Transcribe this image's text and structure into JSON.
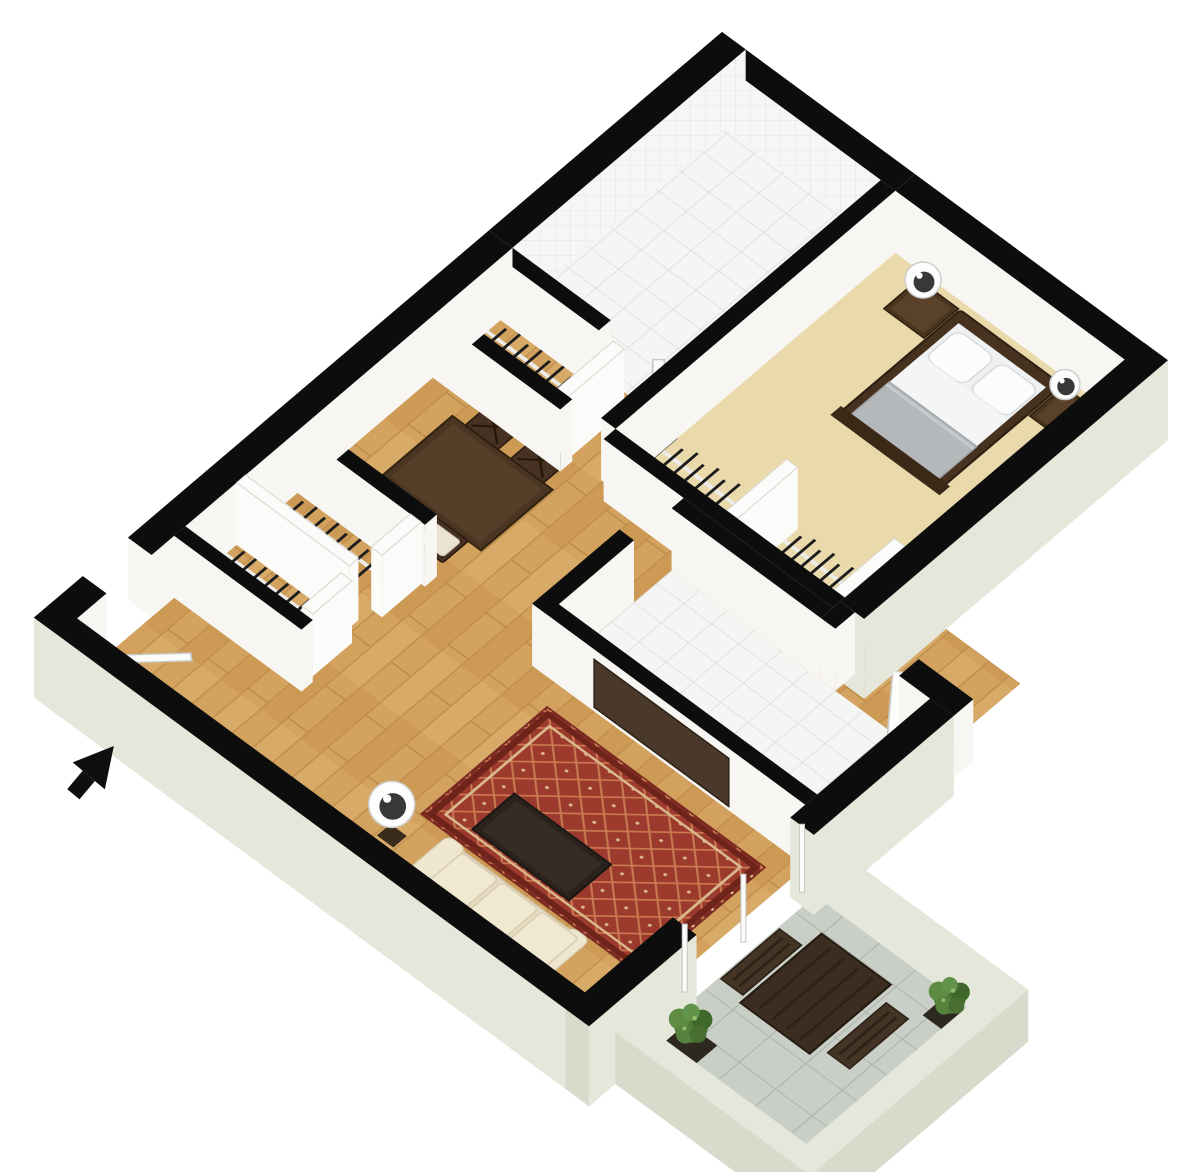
{
  "canvas": {
    "width": 1200,
    "height": 1172
  },
  "floorplan": {
    "view": "3d-isometric-floor-plan",
    "projection": {
      "a": 0.91,
      "b": 0.67,
      "c": -0.752,
      "d": 0.64,
      "e": 722,
      "f": 32
    },
    "wall_height": 62,
    "colors": {
      "wall": "#0d0d0d",
      "interior_face": "#f7f6f3",
      "exterior": "#e5e7db",
      "exterior_shade": "#d8dbcc",
      "panel": "#fbfbf9",
      "carpet": "#eadaab",
      "wood_base": "#d2a25e",
      "tile_white": "#f5f5f3",
      "tile_gray": "#c9cec6",
      "rug_field": "#9d3a2e",
      "rug_accent": "#d9b98c",
      "dark_wood": "#4a3522",
      "espresso": "#2a231d",
      "sofa_cream": "#e6dcc3",
      "bedding_white": "#f2f3f4",
      "blanket_gray": "#b5b8ba",
      "foliage_green": "#4e7a37",
      "arrow_black": "#0f0f0f"
    },
    "floors": [
      {
        "name": "floor-living-dining-wood",
        "rect": [
          26,
          310,
          584,
          889
        ],
        "surface": "wood"
      },
      {
        "name": "floor-bedroom-carpet",
        "rect": [
          212,
          26,
          464,
          398
        ],
        "surface": "carpet"
      },
      {
        "name": "floor-bathroom-tile",
        "rect": [
          26,
          26,
          196,
          310
        ],
        "surface": "tile"
      },
      {
        "name": "floor-kitchen-tile",
        "rect": [
          300,
          430,
          584,
          580
        ],
        "surface": "tile"
      },
      {
        "name": "floor-balcony-tile",
        "rect": [
          610,
          614,
          800,
          856
        ],
        "surface": "tile-gray"
      }
    ],
    "walls": [
      {
        "name": "wall-ne-bathroom",
        "rect": [
          0,
          0,
          212,
          26
        ],
        "face": "tile"
      },
      {
        "name": "wall-ne-bedroom",
        "rect": [
          212,
          0,
          490,
          26
        ],
        "face": "white"
      },
      {
        "name": "wall-nw-bathroom",
        "rect": [
          0,
          0,
          26,
          310
        ],
        "face": "tile"
      },
      {
        "name": "wall-nw-mid",
        "rect": [
          0,
          310,
          26,
          790
        ],
        "face": "white"
      },
      {
        "name": "wall-nw-end",
        "rect": [
          0,
          850,
          26,
          915
        ],
        "face": "white"
      },
      {
        "name": "wall-sw-living",
        "rect": [
          0,
          889,
          610,
          915
        ],
        "face": "pale",
        "cap": "pale-dark",
        "ext": true
      },
      {
        "name": "wall-se-bedroom",
        "rect": [
          464,
          0,
          490,
          404
        ],
        "face": "pale",
        "ext": true
      },
      {
        "name": "wall-step-a",
        "rect": [
          464,
          404,
          480,
          430
        ],
        "face": "white"
      },
      {
        "name": "wall-step-b",
        "rect": [
          550,
          404,
          610,
          430
        ],
        "face": "white"
      },
      {
        "name": "wall-se-wing-a",
        "rect": [
          584,
          430,
          610,
          616
        ],
        "face": "pale",
        "ext": true
      },
      {
        "name": "wall-se-wing-b",
        "rect": [
          584,
          772,
          610,
          915
        ],
        "face": "pale",
        "cap": "pale-dark",
        "ext": true
      },
      {
        "name": "wall-bath-bedroom-divider",
        "rect": [
          196,
          26,
          212,
          398
        ],
        "face": "white"
      },
      {
        "name": "wall-bath-sw",
        "rect": [
          26,
          310,
          134,
          326
        ],
        "face": "white"
      },
      {
        "name": "panel-linen-side",
        "rect": [
          150,
          326,
          162,
          400
        ],
        "face": "panel",
        "top": "panel"
      },
      {
        "name": "wall-linen-sw",
        "rect": [
          26,
          400,
          166,
          416
        ],
        "face": "white"
      },
      {
        "name": "wall-closet-back",
        "rect": [
          212,
          398,
          464,
          414
        ],
        "face": "white"
      },
      {
        "name": "wall-kitchen-ne",
        "rect": [
          300,
          414,
          464,
          430
        ],
        "face": "white"
      },
      {
        "name": "panel-closet-divider-a",
        "rect": [
          334,
          318,
          346,
          398
        ],
        "face": "panel",
        "top": "panel"
      },
      {
        "name": "panel-closet-divider-b",
        "rect": [
          452,
          318,
          464,
          398
        ],
        "face": "panel",
        "top": "panel"
      },
      {
        "name": "wall-kitchen-nw",
        "rect": [
          284,
          480,
          300,
          596
        ],
        "face": "white"
      },
      {
        "name": "wall-kitchen-sw-tv",
        "rect": [
          284,
          580,
          584,
          596
        ],
        "face": "white"
      },
      {
        "name": "wall-hall-closet-n",
        "rect": [
          26,
          580,
          166,
          596
        ],
        "face": "white"
      },
      {
        "name": "panel-hall-closet-divider",
        "rect": [
          26,
          665,
          150,
          677
        ],
        "face": "panel",
        "top": "panel"
      },
      {
        "name": "wall-hall-closet-s",
        "rect": [
          26,
          745,
          166,
          760
        ],
        "face": "white"
      },
      {
        "name": "panel-hall-closet-post-a",
        "rect": [
          150,
          596,
          162,
          648
        ],
        "face": "panel",
        "top": "panel"
      },
      {
        "name": "panel-hall-closet-post-b",
        "rect": [
          150,
          688,
          162,
          740
        ],
        "face": "panel",
        "top": "panel"
      },
      {
        "name": "parapet-balcony-ne",
        "rect": [
          610,
          590,
          824,
          614
        ],
        "face": "pale",
        "top": "pale",
        "h": 34
      },
      {
        "name": "parapet-balcony-se",
        "rect": [
          800,
          590,
          824,
          880
        ],
        "face": "pale-dark",
        "top": "pale",
        "h": 34,
        "ext": true
      },
      {
        "name": "parapet-balcony-sw",
        "rect": [
          610,
          856,
          824,
          880
        ],
        "face": "pale-dark",
        "top": "pale",
        "h": 34,
        "ext": true
      }
    ],
    "furniture": [
      {
        "name": "bed-frame",
        "type": "rect",
        "r": [
          290,
          34,
          402,
          198
        ],
        "fill": "#46321e",
        "stroke": "#2f2013",
        "sw": 2,
        "rx": 3
      },
      {
        "name": "bed-mattress",
        "type": "rect",
        "r": [
          298,
          46,
          394,
          190
        ],
        "fill": "#eef0f1"
      },
      {
        "name": "bed-pillow-left",
        "type": "rect",
        "r": [
          302,
          52,
          344,
          96
        ],
        "fill": "#fbfcfd",
        "stroke": "#d9dbdd",
        "sw": 1.5,
        "rx": 9
      },
      {
        "name": "bed-pillow-right",
        "type": "rect",
        "r": [
          350,
          52,
          392,
          96
        ],
        "fill": "#fbfcfd",
        "stroke": "#d9dbdd",
        "sw": 1.5,
        "rx": 9
      },
      {
        "name": "bed-sheet",
        "type": "rect",
        "r": [
          298,
          96,
          394,
          150
        ],
        "fill": "#f4f5f6"
      },
      {
        "name": "bed-blanket",
        "type": "rect",
        "r": [
          298,
          138,
          394,
          190
        ],
        "fill": "#b5b8ba",
        "stroke": "#a3a6a8",
        "sw": 1.5
      },
      {
        "name": "bed-blanket-fold",
        "type": "line",
        "a": [
          298,
          142
        ],
        "b": [
          394,
          142
        ],
        "stroke": "#c8cbcd",
        "w": 3
      },
      {
        "name": "bed-footboard",
        "type": "rect",
        "r": [
          286,
          188,
          406,
          202
        ],
        "fill": "#3a2916"
      },
      {
        "name": "nightstand-left",
        "type": "rect",
        "r": [
          244,
          34,
          288,
          80
        ],
        "fill": "#4a3420",
        "stroke": "#30210f",
        "sw": 1.5
      },
      {
        "name": "nightstand-left-top",
        "type": "rect",
        "r": [
          248,
          38,
          284,
          76
        ],
        "fill": "#5a4129"
      },
      {
        "name": "nightstand-right",
        "type": "rect",
        "r": [
          404,
          34,
          448,
          80
        ],
        "fill": "#4a3420",
        "stroke": "#30210f",
        "sw": 1.5
      },
      {
        "name": "nightstand-right-top",
        "type": "rect",
        "r": [
          408,
          38,
          444,
          76
        ],
        "fill": "#5a4129"
      },
      {
        "name": "dining-table",
        "type": "rect",
        "r": [
          64,
          436,
          174,
          531
        ],
        "fill": "#4a3522",
        "stroke": "#33240f",
        "sw": 2
      },
      {
        "name": "dining-table-top",
        "type": "rect",
        "r": [
          70,
          442,
          168,
          525
        ],
        "fill": "#563f28"
      },
      {
        "name": "dining-chair-ne-1",
        "type": "chair",
        "r": [
          78,
          402,
          114,
          436
        ],
        "fill": "#463122",
        "cushion": false
      },
      {
        "name": "dining-chair-ne-2",
        "type": "chair",
        "r": [
          128,
          402,
          164,
          436
        ],
        "fill": "#463122",
        "cushion": false
      },
      {
        "name": "dining-chair-sw-1",
        "type": "chair",
        "r": [
          74,
          531,
          110,
          565
        ],
        "fill": "#463122",
        "cushion": true
      },
      {
        "name": "dining-chair-sw-2",
        "type": "chair",
        "r": [
          124,
          531,
          160,
          565
        ],
        "fill": "#463122",
        "cushion": true
      },
      {
        "name": "area-rug-base",
        "type": "rect",
        "r": [
          322,
          622,
          560,
          788
        ],
        "fill": "#9d3a2e",
        "stroke": "#7a2a20",
        "sw": 3
      },
      {
        "name": "area-rug-lattice",
        "type": "rect",
        "r": [
          322,
          622,
          560,
          788
        ],
        "fill": "url(#pRug)"
      },
      {
        "name": "area-rug-border-outer",
        "type": "rect",
        "r": [
          327,
          627,
          555,
          783
        ],
        "fill": "none",
        "stroke": "#6f241b",
        "sw": 6
      },
      {
        "name": "area-rug-border-inner",
        "type": "rect",
        "r": [
          336,
          636,
          546,
          774
        ],
        "fill": "none",
        "stroke": "#d9b98c",
        "sw": 2.5
      },
      {
        "name": "coffee-table",
        "type": "rect",
        "r": [
          362,
          714,
          468,
          770
        ],
        "fill": "#2a231d",
        "stroke": "#1c1713",
        "sw": 2
      },
      {
        "name": "coffee-table-top",
        "type": "rect",
        "r": [
          368,
          719,
          462,
          765
        ],
        "fill": "#352c24"
      },
      {
        "name": "sofa-base",
        "type": "rect",
        "r": [
          352,
          794,
          508,
          886
        ],
        "fill": "#e6dcc3",
        "stroke": "#cfc4a8",
        "sw": 1.5,
        "rx": 6
      },
      {
        "name": "sofa-back",
        "type": "rect",
        "r": [
          370,
          848,
          490,
          884
        ],
        "fill": "#e0d5ba"
      },
      {
        "name": "sofa-arm-left",
        "type": "rect",
        "r": [
          352,
          790,
          372,
          886
        ],
        "fill": "#efe6cf",
        "stroke": "#d8cdb1",
        "sw": 1,
        "rx": 7
      },
      {
        "name": "sofa-arm-right",
        "type": "rect",
        "r": [
          488,
          790,
          508,
          886
        ],
        "fill": "#efe6cf",
        "stroke": "#d8cdb1",
        "sw": 1,
        "rx": 7
      },
      {
        "name": "sofa-cushion-1",
        "type": "rect",
        "r": [
          372,
          796,
          412,
          850
        ],
        "fill": "#f1e8d1",
        "stroke": "#d8cdb1",
        "sw": 1.5,
        "rx": 4
      },
      {
        "name": "sofa-cushion-2",
        "type": "rect",
        "r": [
          416,
          796,
          456,
          850
        ],
        "fill": "#f1e8d1",
        "stroke": "#d8cdb1",
        "sw": 1.5,
        "rx": 4
      },
      {
        "name": "sofa-cushion-3",
        "type": "rect",
        "r": [
          460,
          796,
          500,
          850
        ],
        "fill": "#f1e8d1",
        "stroke": "#d8cdb1",
        "sw": 1.5,
        "rx": 4
      },
      {
        "name": "floor-lamp-base",
        "type": "rect",
        "r": [
          310,
          816,
          328,
          834
        ],
        "fill": "#3a2b1b"
      },
      {
        "name": "balcony-table",
        "type": "rect",
        "r": [
          640,
          642,
          716,
          750
        ],
        "fill": "#3b2e21",
        "stroke": "#261c11",
        "sw": 2
      },
      {
        "name": "balcony-table-slats",
        "type": "slats",
        "r": [
          640,
          642,
          716,
          750
        ],
        "n": 4,
        "stroke": "#2c2217"
      },
      {
        "name": "balcony-bench-west",
        "type": "rect",
        "r": [
          612,
          664,
          636,
          742
        ],
        "fill": "#443426",
        "stroke": "#2c2117",
        "sw": 1.5
      },
      {
        "name": "balcony-bench-west-slats",
        "type": "slats",
        "r": [
          612,
          664,
          636,
          742
        ],
        "n": 2,
        "stroke": "#2c2217"
      },
      {
        "name": "balcony-bench-east",
        "type": "rect",
        "r": [
          726,
          660,
          750,
          738
        ],
        "fill": "#443426",
        "stroke": "#2c2117",
        "sw": 1.5
      },
      {
        "name": "balcony-bench-east-slats",
        "type": "slats",
        "r": [
          726,
          660,
          750,
          738
        ],
        "n": 2,
        "stroke": "#2c2217"
      },
      {
        "name": "plant-pot-north",
        "type": "rect",
        "r": [
          756,
          618,
          788,
          648
        ],
        "fill": "#2e2920"
      },
      {
        "name": "plant-pot-south",
        "type": "rect",
        "r": [
          622,
          800,
          656,
          832
        ],
        "fill": "#2e2920"
      },
      {
        "name": "entry-door-slab",
        "type": "poly",
        "pts": [
          [
            26,
            850
          ],
          [
            74,
            796
          ],
          [
            80,
            802
          ],
          [
            32,
            856
          ]
        ],
        "fill": "#fcfcfb",
        "stroke": "#c9c9c5",
        "sw": 1.5
      },
      {
        "name": "bedroom-door-slab",
        "type": "poly",
        "pts": [
          [
            550,
            430
          ],
          [
            508,
            372
          ],
          [
            500,
            378
          ],
          [
            542,
            436
          ]
        ],
        "fill": "#fcfcfb",
        "stroke": "#c9c9c5",
        "sw": 1.5
      },
      {
        "name": "bathroom-door-slab",
        "type": "poly",
        "pts": [
          [
            192,
            310
          ],
          [
            150,
            258
          ],
          [
            143,
            265
          ],
          [
            185,
            317
          ]
        ],
        "fill": "#fcfcfb",
        "stroke": "#c9c9c5",
        "sw": 1.5
      }
    ],
    "closet_rods": [
      {
        "name": "linen-closet-rod",
        "a": [
          34,
          364
        ],
        "b": [
          142,
          364
        ],
        "hangers": 9
      },
      {
        "name": "bedroom-closet-rod-a",
        "a": [
          222,
          356
        ],
        "b": [
          326,
          356
        ],
        "hangers": 9
      },
      {
        "name": "bedroom-closet-rod-b",
        "a": [
          354,
          356
        ],
        "b": [
          448,
          356
        ],
        "hangers": 9
      },
      {
        "name": "hall-closet-rod-a",
        "a": [
          34,
          634
        ],
        "b": [
          142,
          634
        ],
        "hangers": 9
      },
      {
        "name": "hall-closet-rod-b",
        "a": [
          34,
          712
        ],
        "b": [
          142,
          712
        ],
        "hangers": 9
      }
    ],
    "screen_items": [
      {
        "name": "tv-panel",
        "type": "wallpanel",
        "u1": 352,
        "u2": 500,
        "v": 596,
        "y1": 10,
        "y2": 58,
        "fill": "#4a392a",
        "stroke": "#2c2115"
      },
      {
        "name": "sliding-door-frame",
        "type": "posts",
        "u": 597,
        "vs": [
          616,
          694,
          772
        ]
      },
      {
        "name": "nightstand-lamp-left",
        "type": "lamp",
        "c": [
          268,
          57
        ],
        "r": 18
      },
      {
        "name": "nightstand-lamp-right",
        "type": "lamp",
        "c": [
          424,
          57
        ],
        "r": 15
      },
      {
        "name": "living-floor-lamp",
        "type": "lamp",
        "c": [
          318,
          824
        ],
        "r": 23
      },
      {
        "name": "balcony-plant-north",
        "type": "plant",
        "c": [
          771,
          630
        ],
        "r": 16
      },
      {
        "name": "balcony-plant-south",
        "type": "plant",
        "c": [
          638,
          813
        ],
        "r": 17
      },
      {
        "name": "entry-direction-arrow",
        "type": "arrow",
        "x": 92,
        "y": 772,
        "rot": 40
      }
    ]
  }
}
